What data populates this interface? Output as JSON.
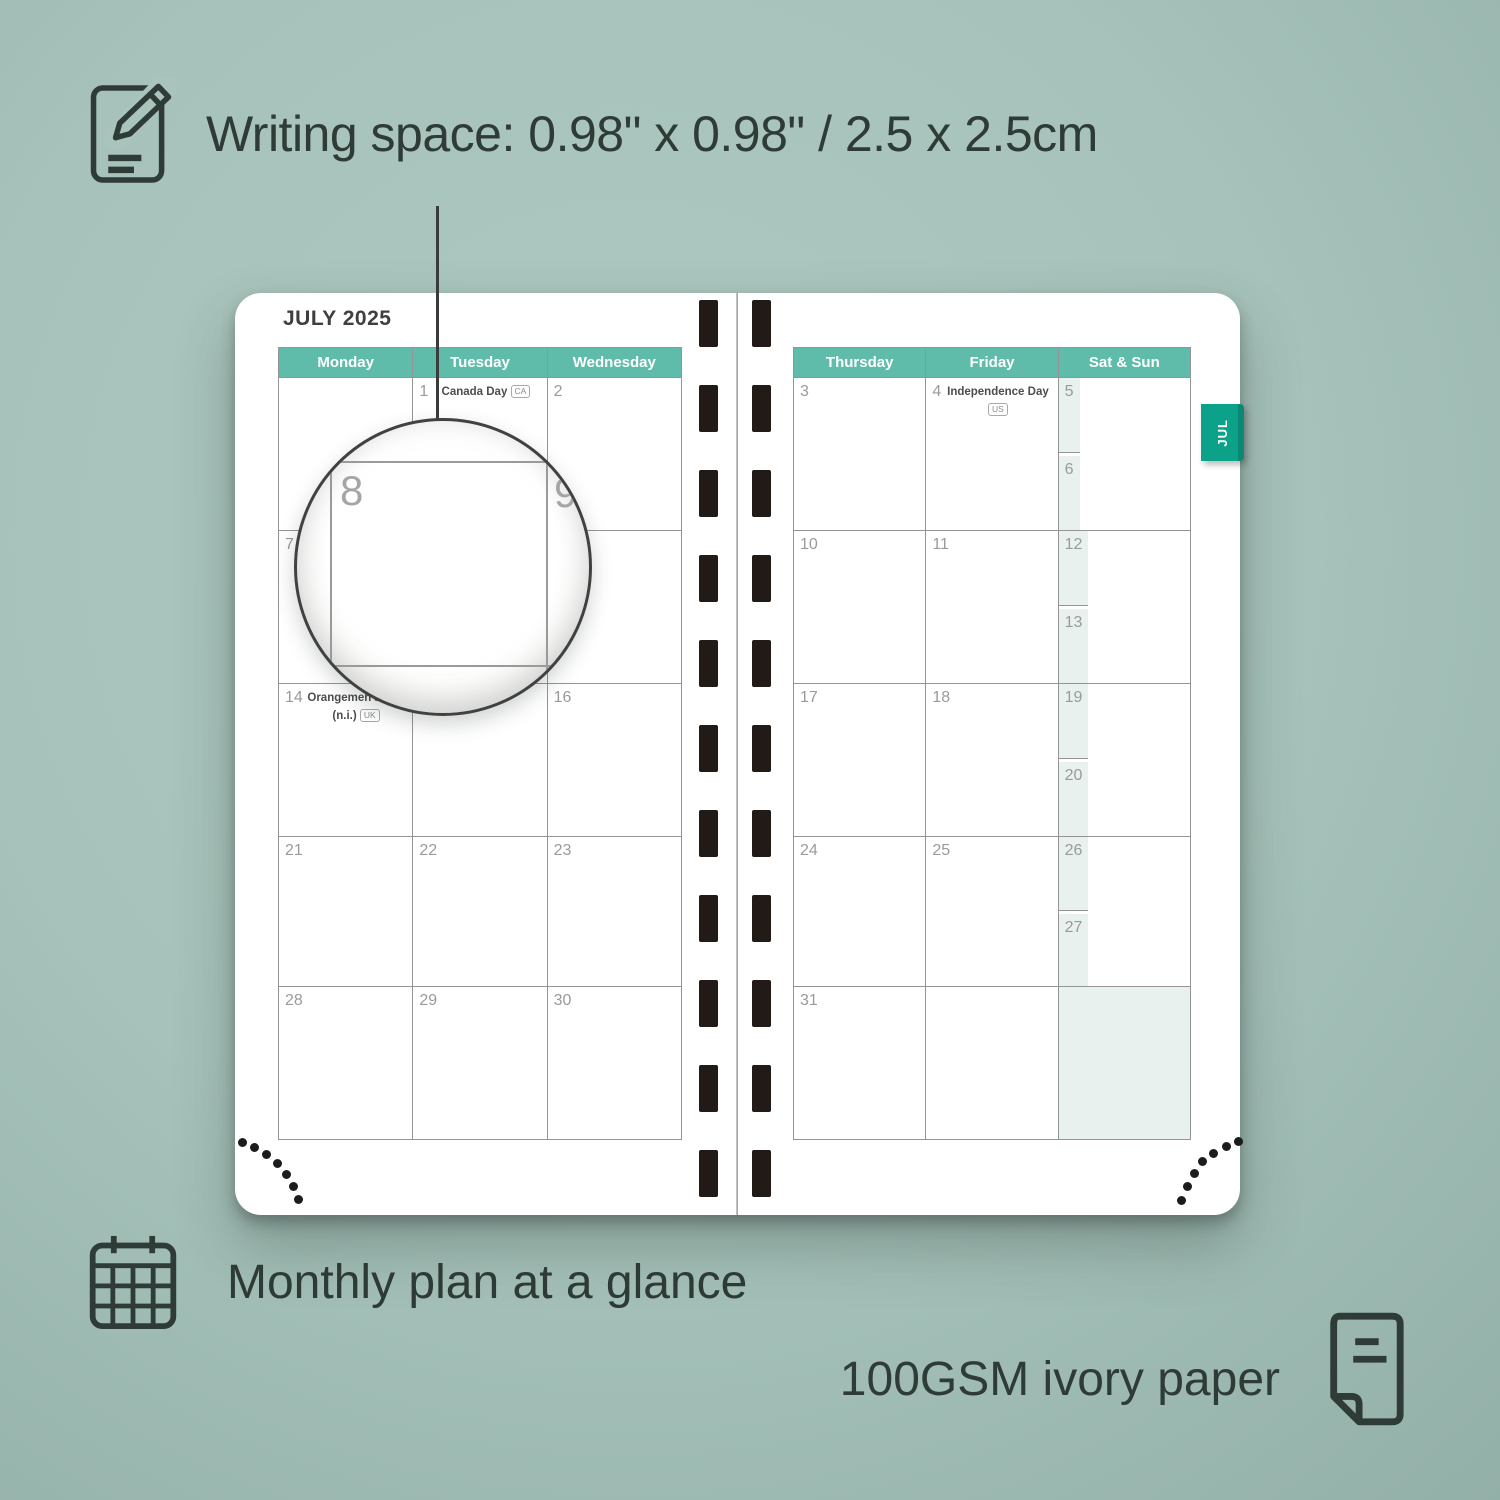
{
  "colors": {
    "background": "#a6c2ba",
    "header_teal": "#5fbcab",
    "tab_teal": "#0ca189",
    "weekend_mint": "#e8f1ee",
    "ink": "#2e3b36",
    "grid_line": "#949494",
    "date_gray": "#9a9a9a"
  },
  "annotations": {
    "writing_space": "Writing space: 0.98\" x 0.98\" / 2.5 x 2.5cm",
    "monthly_plan": "Monthly plan at a glance",
    "paper": "100GSM ivory paper"
  },
  "planner": {
    "month_title": "JULY 2025",
    "tab_label": "JUL",
    "left_page": {
      "headers": [
        "Monday",
        "Tuesday",
        "Wednesday"
      ],
      "weeks": [
        [
          {
            "day": ""
          },
          {
            "day": "1",
            "holiday": "Canada Day",
            "badge": "CA"
          },
          {
            "day": "2"
          }
        ],
        [
          {
            "day": "7"
          },
          {
            "day": "8"
          },
          {
            "day": "9"
          }
        ],
        [
          {
            "day": "14",
            "holiday": "Orangemen's Day (n.i.)",
            "badge": "UK"
          },
          {
            "day": "15"
          },
          {
            "day": "16"
          }
        ],
        [
          {
            "day": "21"
          },
          {
            "day": "22"
          },
          {
            "day": "23"
          }
        ],
        [
          {
            "day": "28"
          },
          {
            "day": "29"
          },
          {
            "day": "30"
          }
        ]
      ]
    },
    "right_page": {
      "headers": [
        "Thursday",
        "Friday",
        "Sat & Sun"
      ],
      "weeks": [
        {
          "thu": {
            "day": "3"
          },
          "fri": {
            "day": "4",
            "holiday": "Independence Day",
            "badge": "US"
          },
          "sat": {
            "day": "5"
          },
          "sun": {
            "day": "6"
          }
        },
        {
          "thu": {
            "day": "10"
          },
          "fri": {
            "day": "11"
          },
          "sat": {
            "day": "12"
          },
          "sun": {
            "day": "13"
          }
        },
        {
          "thu": {
            "day": "17"
          },
          "fri": {
            "day": "18"
          },
          "sat": {
            "day": "19"
          },
          "sun": {
            "day": "20"
          }
        },
        {
          "thu": {
            "day": "24"
          },
          "fri": {
            "day": "25"
          },
          "sat": {
            "day": "26"
          },
          "sun": {
            "day": "27"
          }
        },
        {
          "thu": {
            "day": "31"
          },
          "fri": {
            "day": ""
          },
          "merged": true
        }
      ]
    },
    "magnifier": {
      "day": "8",
      "next_day": "9"
    }
  }
}
